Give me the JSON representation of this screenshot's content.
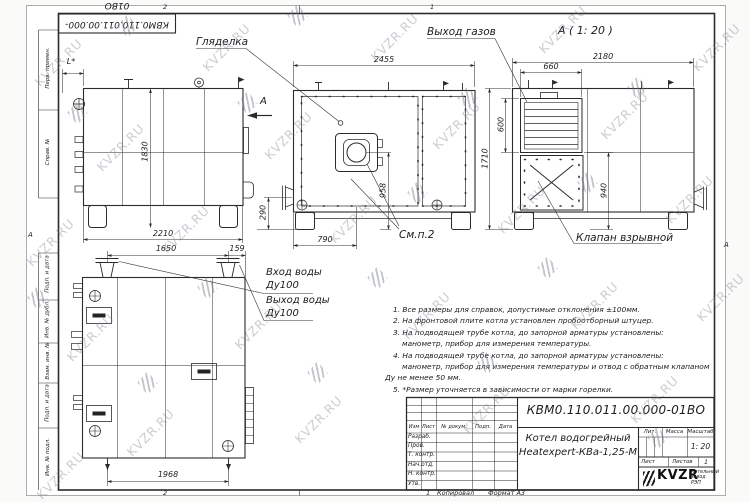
{
  "watermark": {
    "text": "KVZR.RU"
  },
  "sheet": {
    "top_stamp": "КВМ0.110.011.00.000-01ВО",
    "zones": {
      "top_left": "2",
      "top_right": "1",
      "bottom_left": "2",
      "bottom_right": "1",
      "side_left": "А",
      "side_right": "А"
    },
    "footer": {
      "copied": "Копировал",
      "format": "Формат А3"
    },
    "sidebar": [
      "Перв. примен.",
      "Справ. №",
      "Подп. и дата",
      "Инв. № дубл.",
      "Взам. инв. №",
      "Подп. и дата",
      "Инв. № подл."
    ]
  },
  "drawing": {
    "labels": {
      "sight_glass": "Гляделка",
      "gas_outlet": "Выход газов",
      "detail_view_title": "А ( 1: 20 )",
      "explosion_valve": "Клапан взрывной",
      "see_note": "См.п.2",
      "water_inlet": "Вход воды",
      "water_inlet_dn": "Ду100",
      "water_outlet": "Выход воды",
      "water_outlet_dn": "Ду100",
      "section_arrow": "А",
      "dim_l_star": "L*"
    },
    "dimensions": {
      "side_height": "1830",
      "side_width": "2210",
      "flange_height": "290",
      "front_width": "2455",
      "burner_axis_height": "958",
      "burner_axis_offset": "790",
      "rear_width": "2180",
      "grille_width": "660",
      "rear_height": "1710",
      "grille_height": "600",
      "valve_height": "940",
      "top_pipes_span": "1650",
      "top_edge_offset": "159",
      "top_bottom_span": "1968"
    }
  },
  "notes": [
    "1. Все размеры для справок, допустимые отклонения ±100мм.",
    "2. На фронтовой плите котла установлен пробоотборный штуцер.",
    "3. На подводящей трубе котла, до запорной арматуры установлены:",
    "манометр, прибор для измерения температуры.",
    "4. На подводящей трубе котла, до запорной арматуры установлены:",
    "манометр, прибор для измерения температуры и отвод с обратным клапаном",
    "Ду не менее 50 мм.",
    "5. *Размер уточняется в зависимости от марки горелки."
  ],
  "title_block": {
    "doc_number": "КВМ0.110.011.00.000-01ВО",
    "product_line1": "Котел водогрейный",
    "product_line2": "Heatexpert-КВа-1,25-М",
    "scale_value": "1: 20",
    "sheets_value": "1",
    "headers": {
      "izm": "Изм",
      "list": "Лист",
      "doc": "№ докум.",
      "podp": "Подп.",
      "data": "Дата",
      "lit": "Лит.",
      "massa": "Масса",
      "scale": "Масштаб",
      "sheet": "Лист",
      "sheets": "Листов"
    },
    "signature_rows": [
      "Разраб.",
      "Пров.",
      "Т. контр.",
      "Нач.отд.",
      "Н. контр.",
      "Утв."
    ],
    "org": {
      "logo": "KVZR",
      "name_line1": "Котельный",
      "name_line2": "завод РЭП"
    }
  }
}
